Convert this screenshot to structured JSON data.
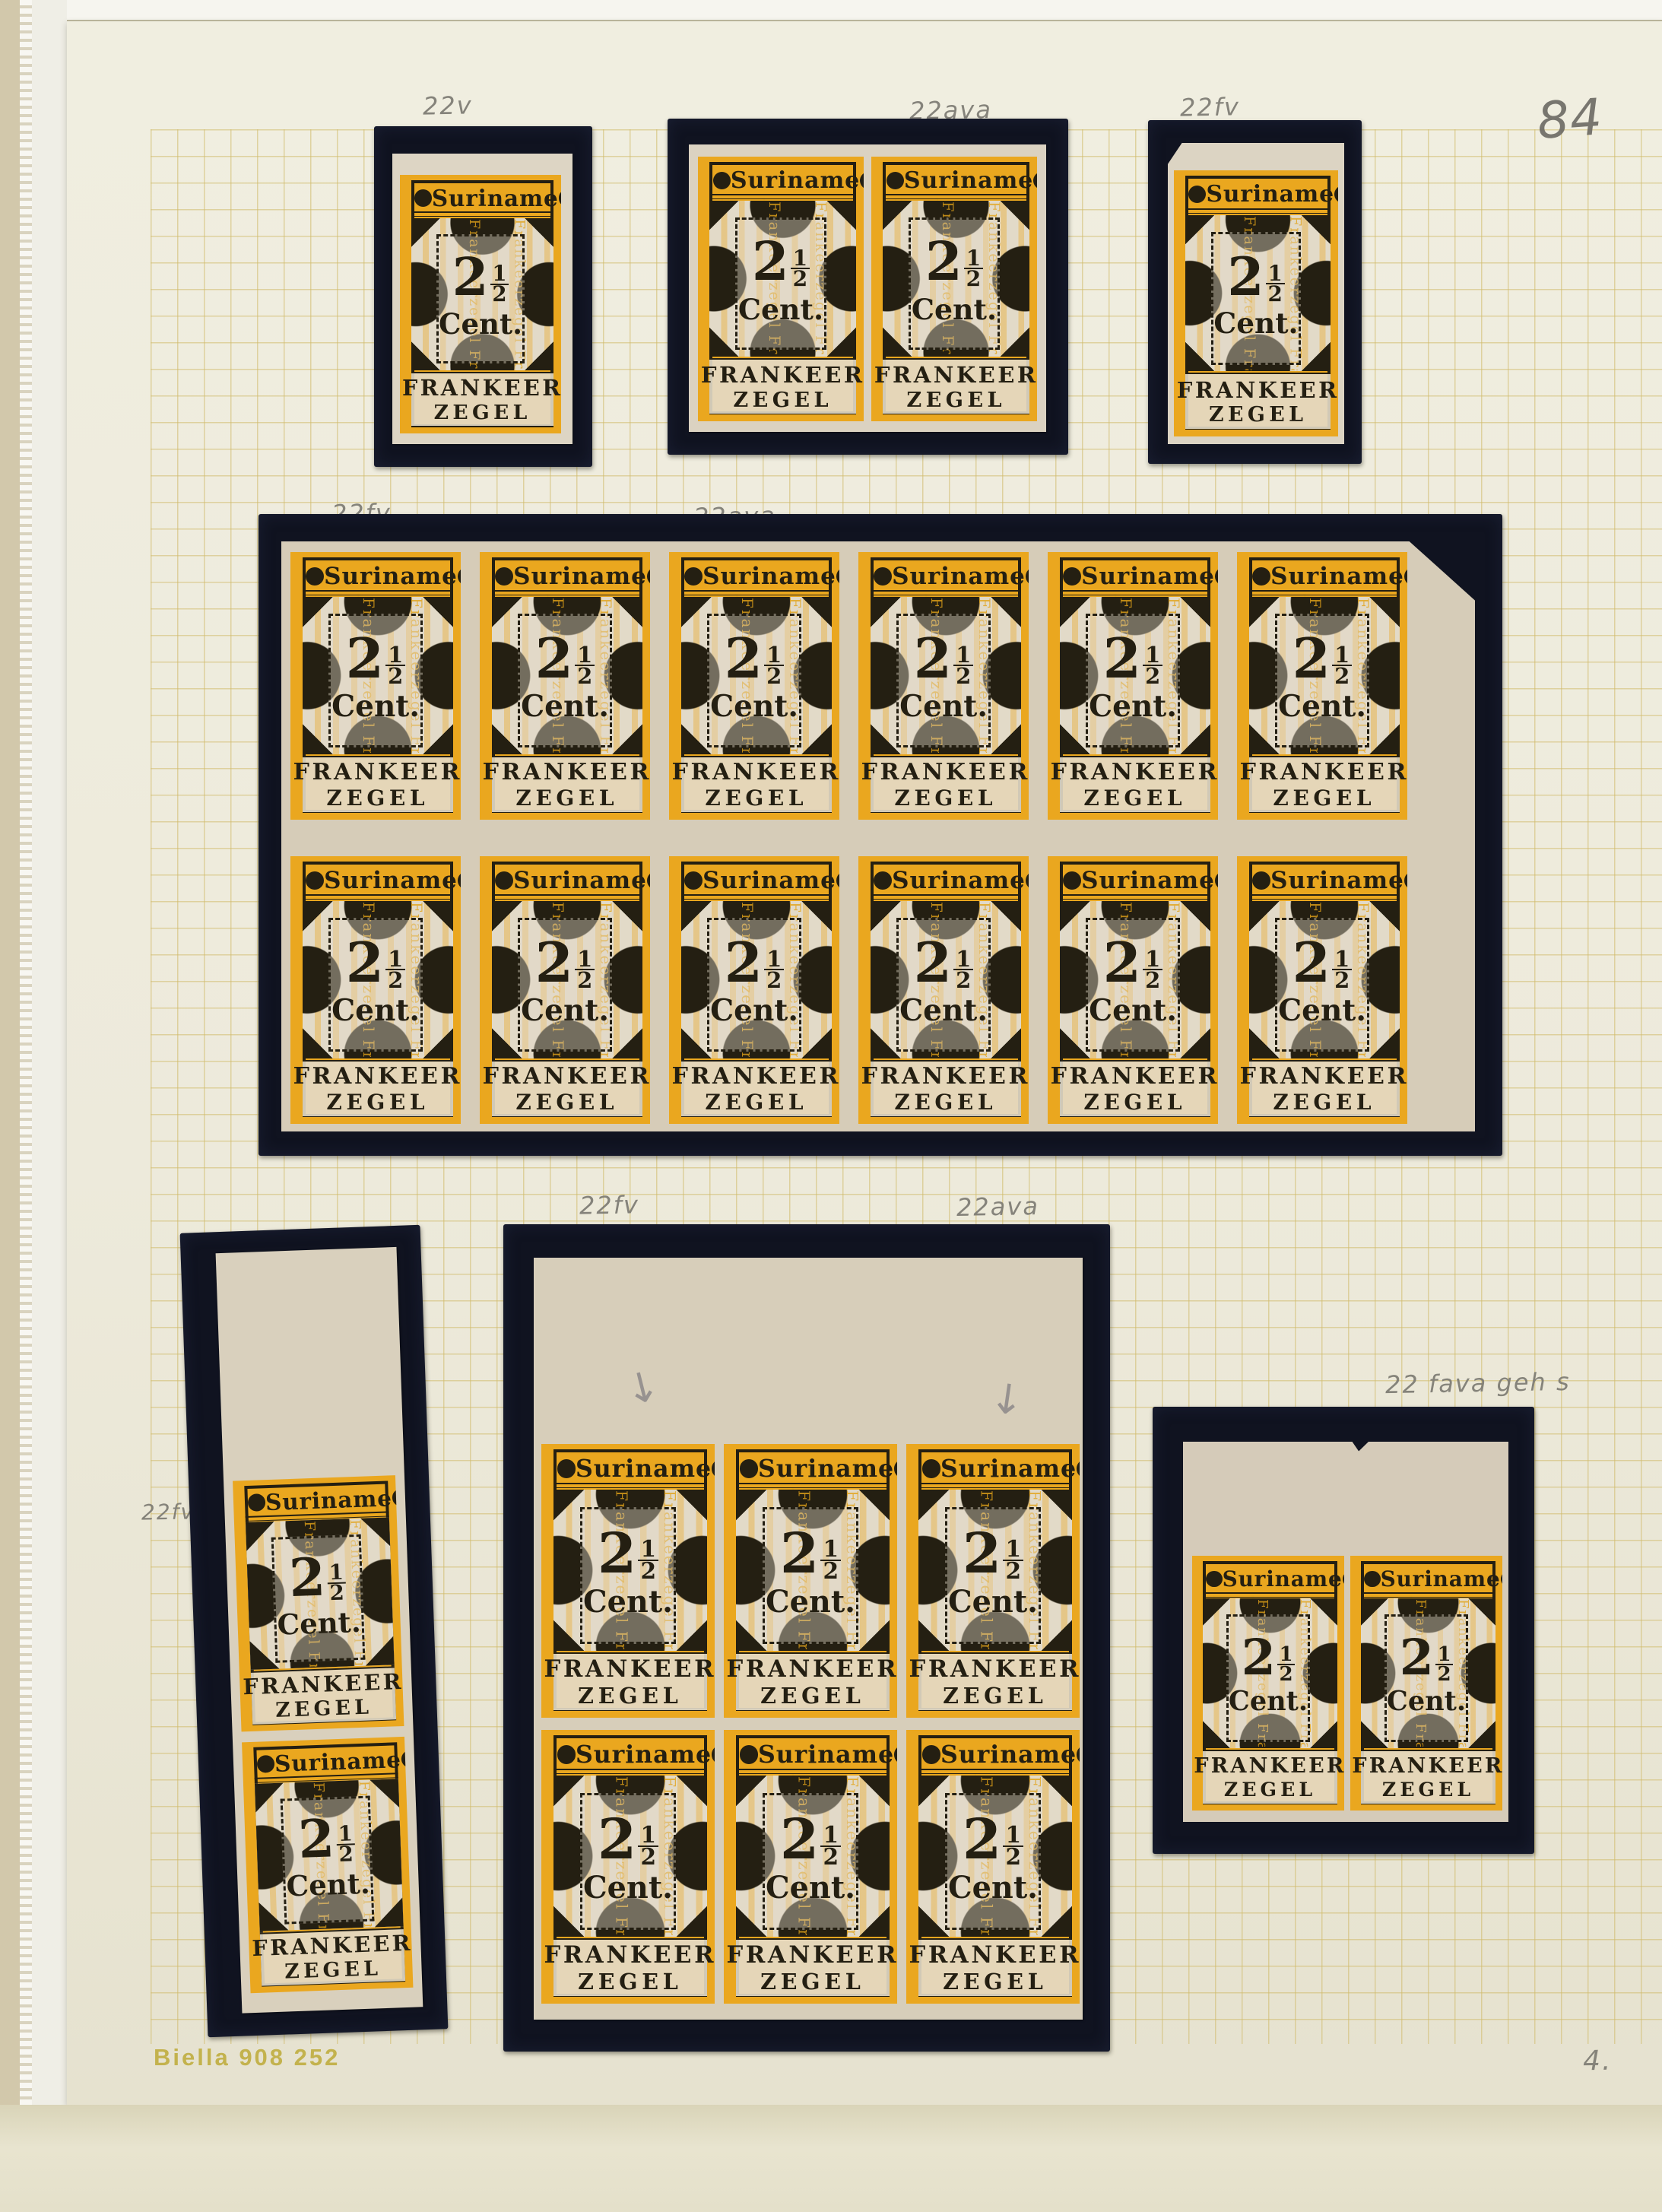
{
  "page": {
    "number": "84",
    "album_print": "Biella 908 252",
    "corner_note": "4."
  },
  "stamp": {
    "country": "Suriname",
    "value_int": "2",
    "value_frac_num": "1",
    "value_frac_den": "2",
    "value_unit": "Cent.",
    "bottom_line1": "FRANKEER",
    "bottom_line2": "ZEGEL",
    "underprint": "Frankeerzegel",
    "underprint_repeat": "Frankeerzegel Frankeerzegel Frankeerzegel Frankeerzegel"
  },
  "groups": [
    {
      "id": "top-left-single",
      "annotation": "22v",
      "rows": 1,
      "cols": 1,
      "stamps": 1
    },
    {
      "id": "top-middle-pair",
      "annotation": "22ava",
      "rows": 1,
      "cols": 2,
      "stamps": 2
    },
    {
      "id": "top-right-single",
      "annotation": "22fv",
      "rows": 1,
      "cols": 1,
      "stamps": 1
    },
    {
      "id": "large-block",
      "annotation_left": "22fv",
      "annotation_right": "22ava",
      "rows": 2,
      "cols": 6,
      "stamps": 12
    },
    {
      "id": "bottom-left-pair",
      "annotation": "22fv",
      "rows": 2,
      "cols": 1,
      "stamps": 2
    },
    {
      "id": "bottom-middle-block",
      "annotation_left": "22fv",
      "annotation_right": "22ava",
      "rows": 2,
      "cols": 3,
      "stamps": 6,
      "pencil_marks": [
        "↓",
        "↓"
      ]
    },
    {
      "id": "bottom-right-pair",
      "annotation": "22 fava geh s",
      "rows": 1,
      "cols": 2,
      "stamps": 2
    }
  ]
}
